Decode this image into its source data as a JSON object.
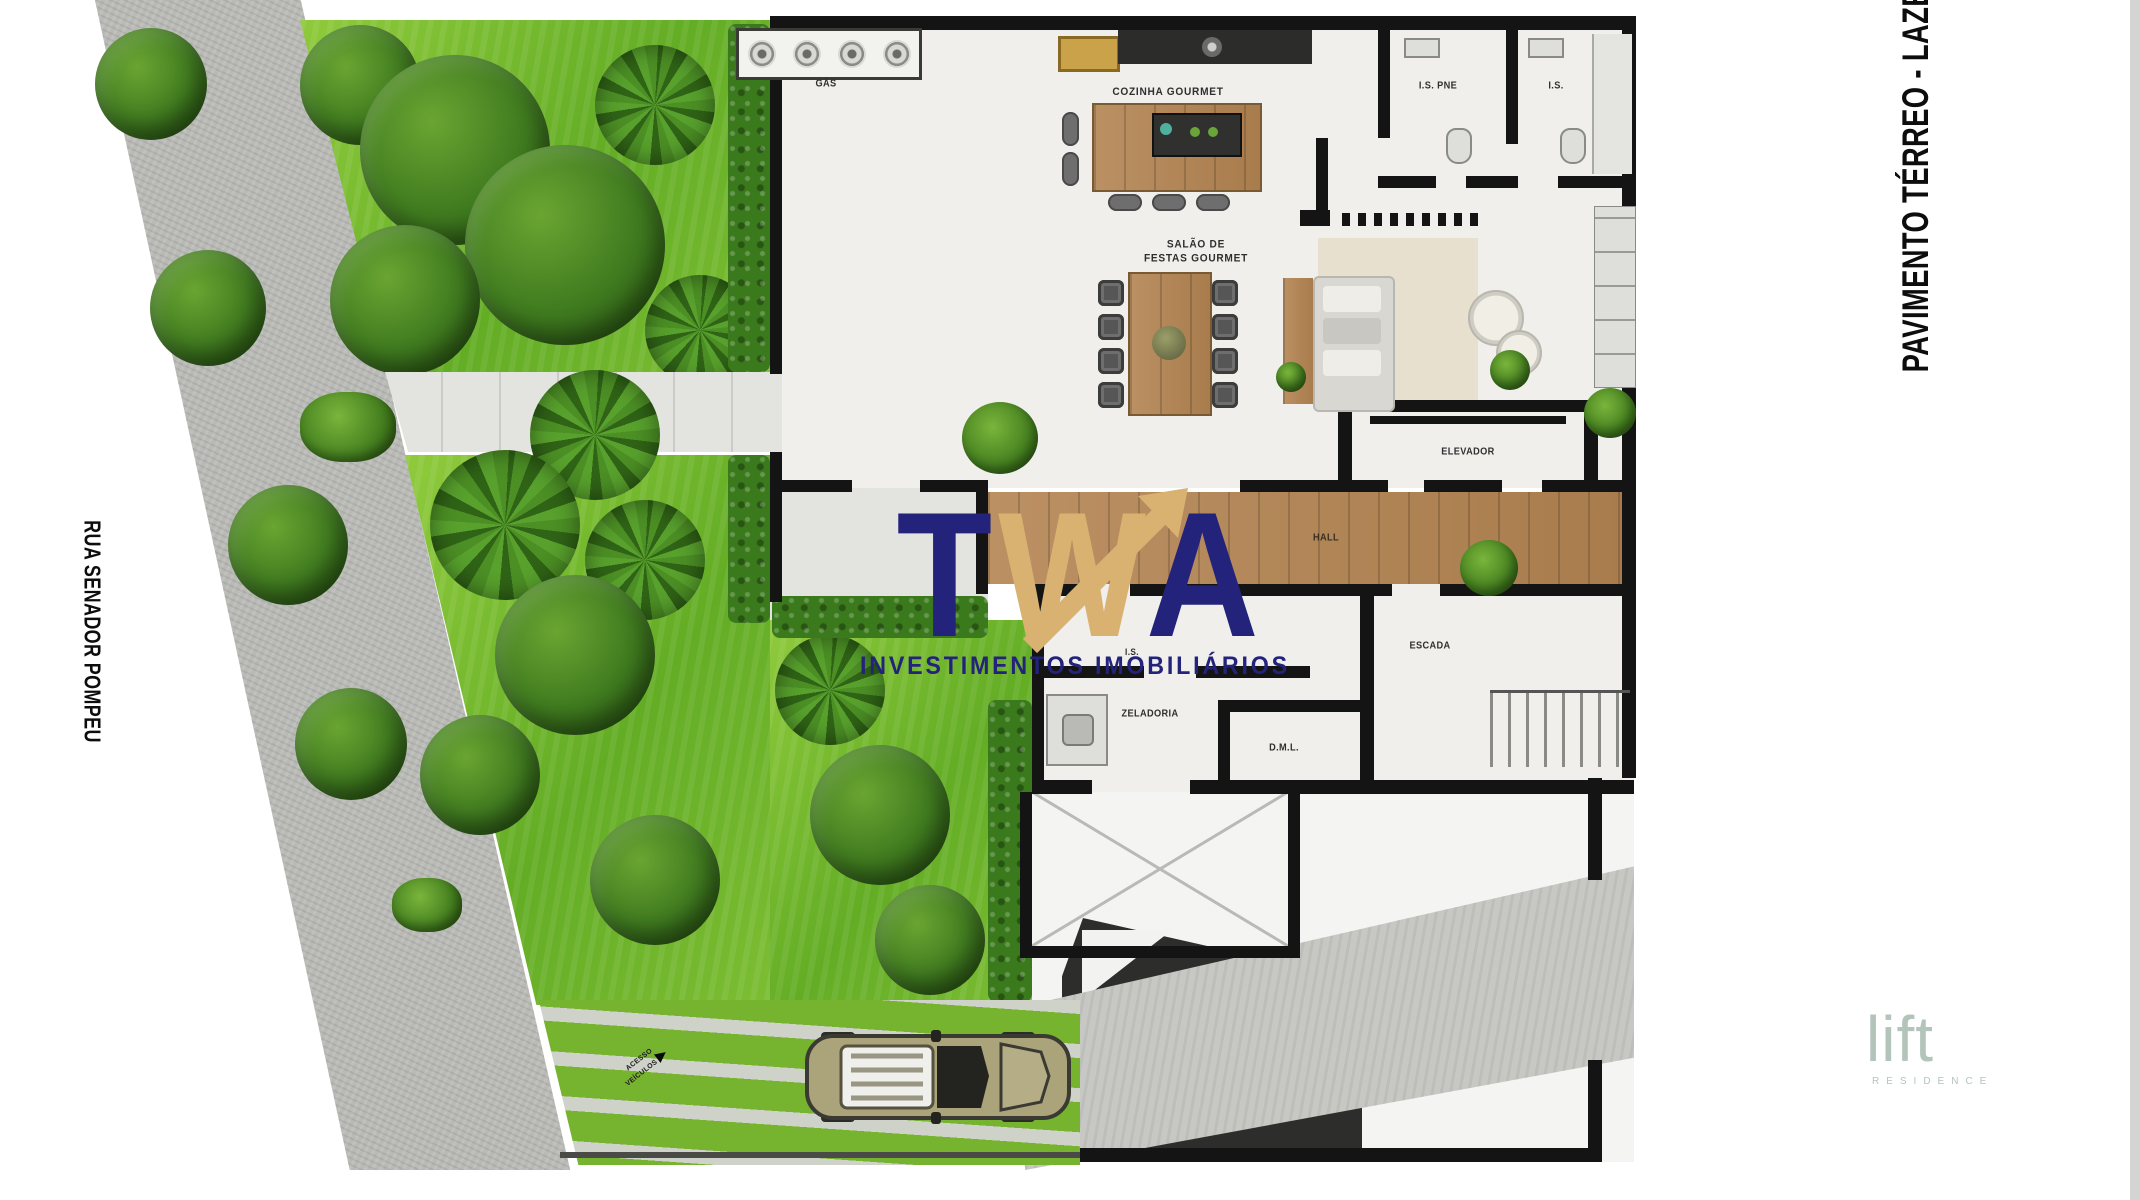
{
  "titles": {
    "floor": "PAVIMENTO TÉRREO - LAZER",
    "street": "RUA SENADOR POMPEU"
  },
  "watermark": {
    "letters": [
      "T",
      "W",
      "A"
    ],
    "tagline": "INVESTIMENTOS IMOBILIÁRIOS",
    "navy": "#23237c",
    "gold": "#d9b272"
  },
  "brand": {
    "name": "lift",
    "tagline": "RESIDENCE",
    "color": "#b3c5bb"
  },
  "rooms": {
    "gas": "GÁS",
    "cozinha": "COZINHA GOURMET",
    "salao_l1": "SALÃO DE",
    "salao_l2": "FESTAS GOURMET",
    "is_pne": "I.S. PNE",
    "is": "I.S.",
    "elevador": "ELEVADOR",
    "hall": "HALL",
    "escada": "ESCADA",
    "is_small": "I.S.",
    "zeladoria": "ZELADORIA",
    "dml": "D.M.L."
  },
  "markers": {
    "pedestrian": {
      "l1": "ACESSO",
      "l2": "SOCIAL"
    },
    "vehicle": {
      "l1": "ACESSO",
      "l2": "VEÍCULOS"
    }
  },
  "colors": {
    "grass": "#79bb2e",
    "tree": "#3f7a1f",
    "sidewalk": "#b9bab6",
    "wall": "#141414",
    "floor": "#f0efec",
    "wood": "#b18453",
    "accent_navy": "#23237c",
    "accent_gold": "#d9b272"
  }
}
